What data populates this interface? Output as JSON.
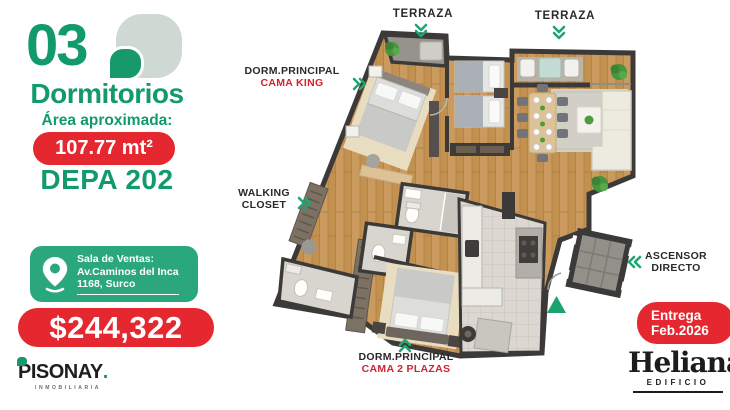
{
  "left_panel": {
    "number": "03",
    "title": "Dormitorios",
    "area_label": "Área aproximada:",
    "area_value": "107.77 mt²",
    "unit": "DEPA 202",
    "sales_office": {
      "title": "Sala de Ventas:",
      "address_line1": "Av.Caminos del Inca",
      "address_line2": "1168, Surco"
    },
    "price": "$244,322"
  },
  "floor_plan_labels": {
    "terraza_left": "TERRAZA",
    "terraza_right": "TERRAZA",
    "master_king": {
      "line1": "DORM.PRINCIPAL",
      "line2": "CAMA KING"
    },
    "walking_closet": {
      "line1": "WALKING",
      "line2": "CLOSET"
    },
    "master_2plazas": {
      "line1": "DORM.PRINCIPAL",
      "line2": "CAMA 2 PLAZAS"
    },
    "elevator": {
      "line1": "ASCENSOR",
      "line2": "DIRECTO"
    }
  },
  "delivery_badge": {
    "line1": "Entrega",
    "line2": "Feb.2026"
  },
  "brands": {
    "developer": {
      "name": "PISONAY",
      "dot": ".",
      "tagline": "INMOBILIARIA"
    },
    "building": {
      "name": "Heliana",
      "subtitle": "EDIFICIO"
    }
  },
  "colors": {
    "green": "#139a6b",
    "teal": "#2ba77e",
    "red": "#e52730",
    "arrow_green": "#1fa673",
    "label_dark": "#2b2a29",
    "cama_red": "#cf2330"
  }
}
